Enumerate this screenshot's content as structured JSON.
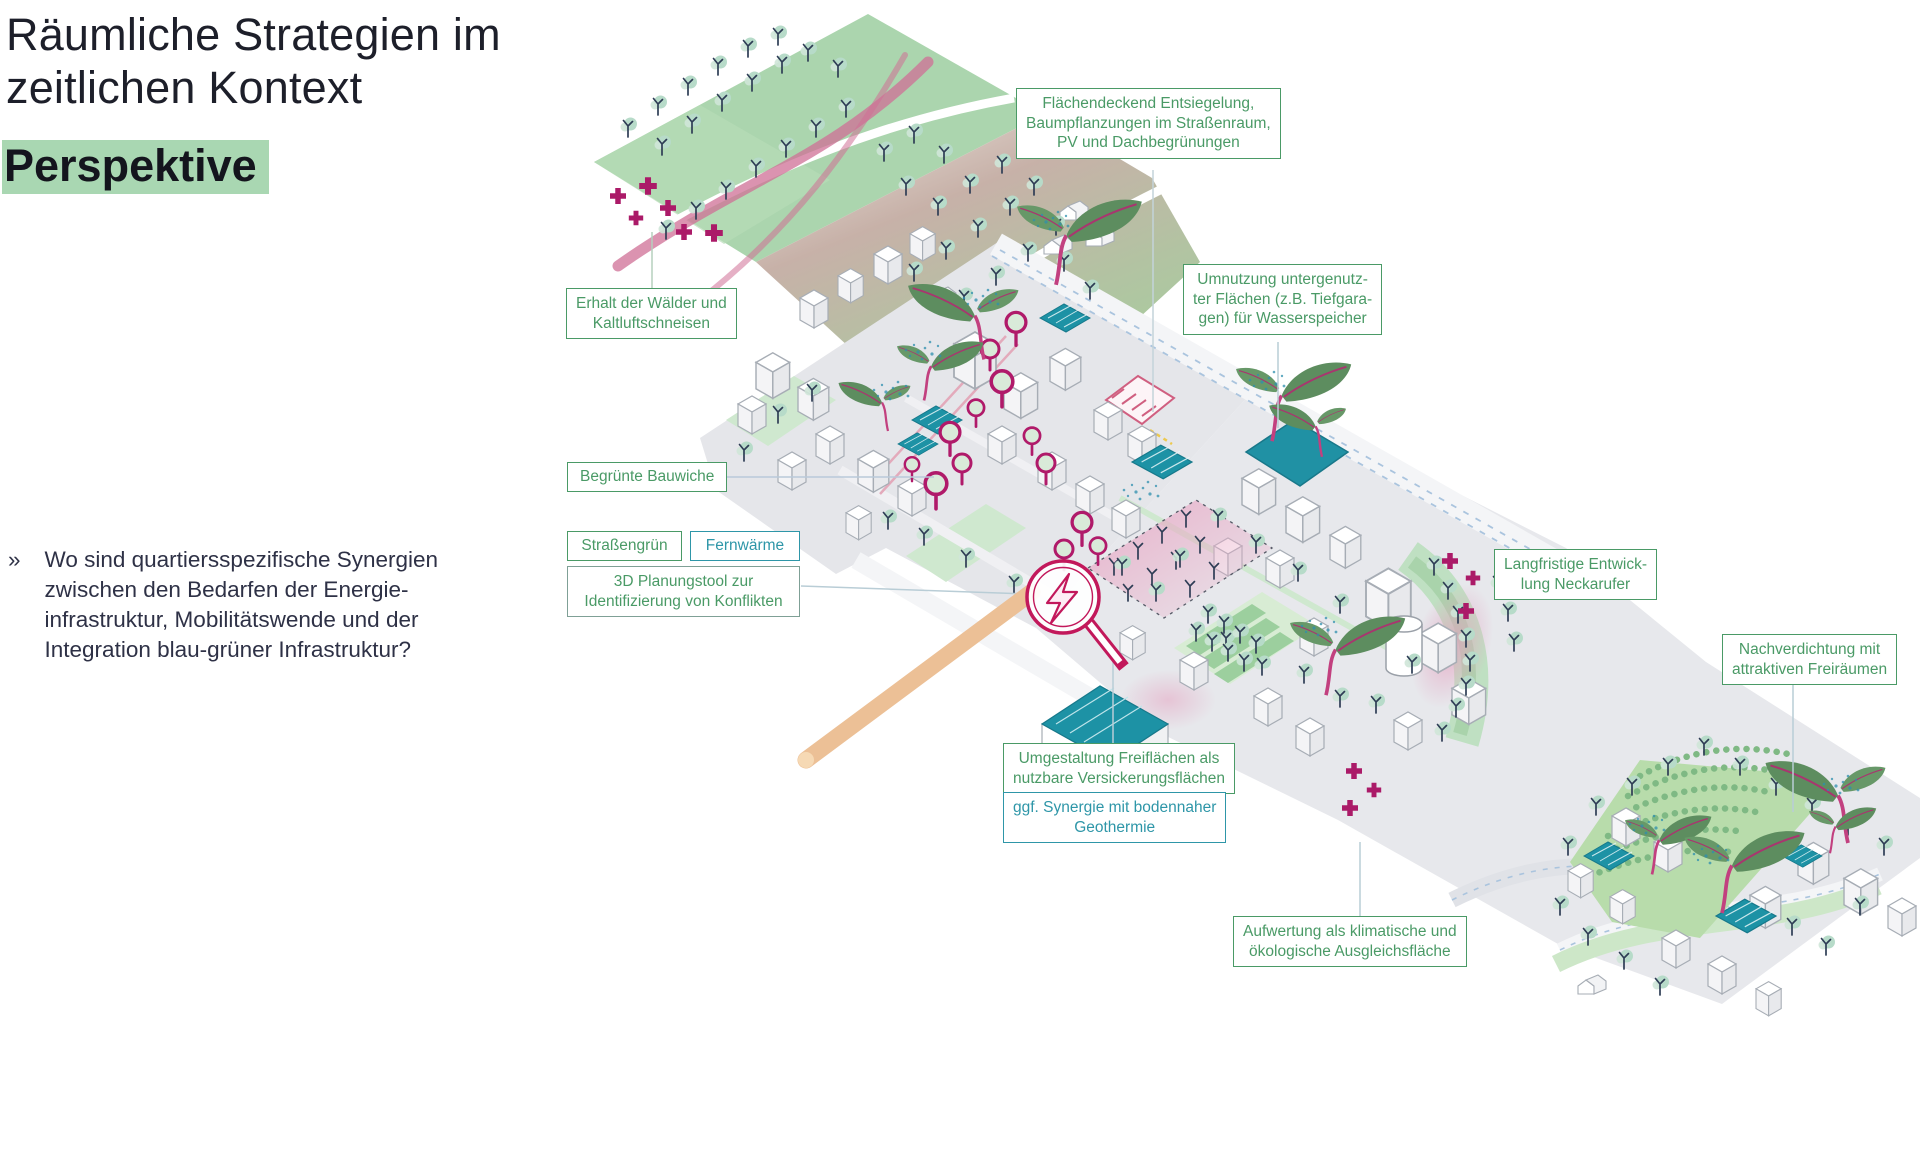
{
  "slide": {
    "title_line1": "Räumliche Strategien im",
    "title_line2": "zeitlichen Kontext",
    "title_highlight": "Perspektive",
    "bullet": {
      "marker": "»",
      "text": "Wo sind quartiersspezifische Synergien\nzwischen den Bedarfen der Energie-\ninfrastruktur, Mobilitätswende und der\nIntegration blau-grüner Infrastruktur?"
    }
  },
  "callouts": {
    "erhalt": {
      "label": "Erhalt der Wälder und\nKaltluftschneisen",
      "style": "green"
    },
    "flaechendeckend": {
      "label": "Flächendeckend Entsiegelung,\nBaumpflanzungen im Straßenraum,\nPV und Dachbegrünungen",
      "style": "green"
    },
    "umnutzung": {
      "label": "Umnutzung untergenutz-\nter Flächen (z.B. Tiefgara-\ngen) für Wasserspeicher",
      "style": "green"
    },
    "begruente": {
      "label": "Begrünte Bauwiche",
      "style": "green"
    },
    "strassengruen": {
      "label": "Straßengrün",
      "style": "green"
    },
    "fernwaerme": {
      "label": "Fernwärme",
      "style": "teal"
    },
    "planungstool": {
      "label": "3D Planungstool zur\nIdentifizierung von Konflikten",
      "style": "green-greyframe"
    },
    "langfristige": {
      "label": "Langfristige Entwick-\nlung Neckarufer",
      "style": "green"
    },
    "nachverdichtung": {
      "label": "Nachverdichtung mit\nattraktiven Freiräumen",
      "style": "green"
    },
    "umgestaltung": {
      "label": "Umgestaltung Freiflächen als\nnutzbare Versickerungsflächen",
      "style": "green"
    },
    "geothermie": {
      "label": "ggf. Synergie mit bodennaher\nGeothermie",
      "style": "teal"
    },
    "aufwertung": {
      "label": "Aufwertung als klimatische und\nökologische Ausgleichsfläche",
      "style": "green"
    }
  },
  "icons": {
    "magnifier": "magnifying-glass-with-lightning-bolt",
    "plus_marker": "densification-plus-marker",
    "tree": "street-tree",
    "pv_panel": "photovoltaic-roof-panel"
  },
  "colors": {
    "green": "#4a9a66",
    "teal": "#2e96a8",
    "magenta": "#b01a6a",
    "highlight_green": "#a9d7b2",
    "ink": "#2e3146",
    "map_green": "#abd5ae",
    "water_teal": "#2091a4",
    "ribbon_pink": "#cf6f95"
  }
}
